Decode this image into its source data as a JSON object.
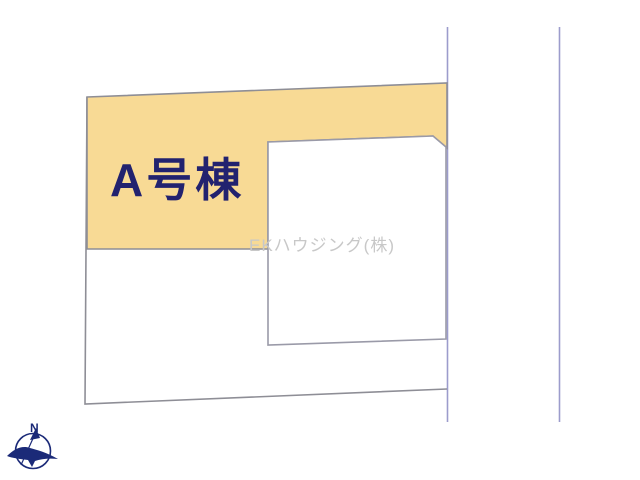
{
  "plan": {
    "lot_label": "A号棟",
    "watermark": "EKハウジング(株)",
    "compass_north_label": "N"
  },
  "icons": {
    "compass": "compass-north-icon"
  },
  "colors": {
    "lot_fill": "#f8da95",
    "lot_border": "#8e8e96",
    "parcel_border": "#9a9aa8",
    "road_line": "#9c9ccc",
    "label_text": "#22226f",
    "watermark_text": "#c8c8c8",
    "compass": "#1b2a78"
  }
}
